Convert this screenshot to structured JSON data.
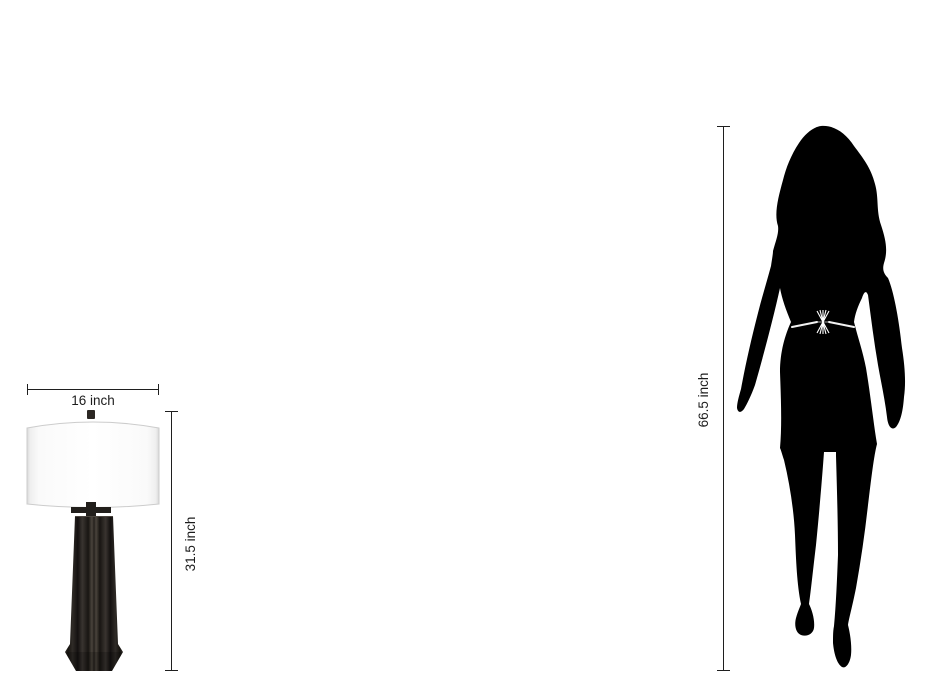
{
  "page": {
    "type": "product-dimension-comparison-diagram",
    "background_color": "#ffffff"
  },
  "product": {
    "name": "table lamp with white drum shade and dark fluted tapered column base",
    "width_label": "16 inch",
    "height_label": "31.5 inch",
    "shade_color": "#fdfdfd",
    "shade_edge_color": "#d9d9d9",
    "base_color": "#26221e",
    "finial_color": "#2b2723"
  },
  "reference_figure": {
    "name": "standing woman silhouette",
    "height_label": "66.5 inch",
    "silhouette_color": "#000000",
    "belt_accent_color": "#ffffff"
  },
  "dimension_style": {
    "line_color": "#1f1f1f",
    "label_color": "#1c1c1c"
  }
}
